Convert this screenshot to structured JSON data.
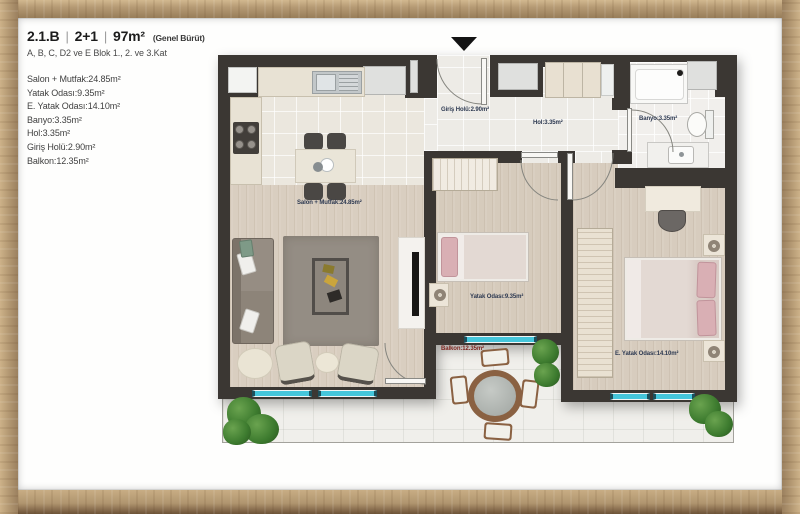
{
  "header": {
    "code": "2.1.B",
    "sep": "|",
    "layout_type": "2+1",
    "area": "97m²",
    "area_note": "(Genel Bürüt)",
    "subtitle": "A, B, C, D2 ve E Blok 1., 2. ve 3.Kat"
  },
  "rooms": [
    "Salon + Mutfak:24.85m²",
    "Yatak Odası:9.35m²",
    "E. Yatak Odası:14.10m²",
    "Banyo:3.35m²",
    "Hol:3.35m²",
    "Giriş Holü:2.90m²",
    "Balkon:12.35m²"
  ],
  "plan": {
    "labels": {
      "salon": "Salon + Mutfak:24.85m²",
      "giris": "Giriş Holü:2.90m²",
      "hol": "Hol:3.35m²",
      "banyo": "Banyo:3.35m²",
      "yatak": "Yatak Odası:9.35m²",
      "e_yatak": "E. Yatak Odası:14.10m²",
      "balkon": "Balkon:12.35m²"
    }
  },
  "colors": {
    "wall": "#3b3733",
    "window_glass": "#45c6db",
    "label_navy": "#2e3a52",
    "label_balcony_red": "#7d2620",
    "frame_wood": "#b59a74",
    "wood_floor": "#d9cec0",
    "pillow_pink": "#d9afb4"
  }
}
